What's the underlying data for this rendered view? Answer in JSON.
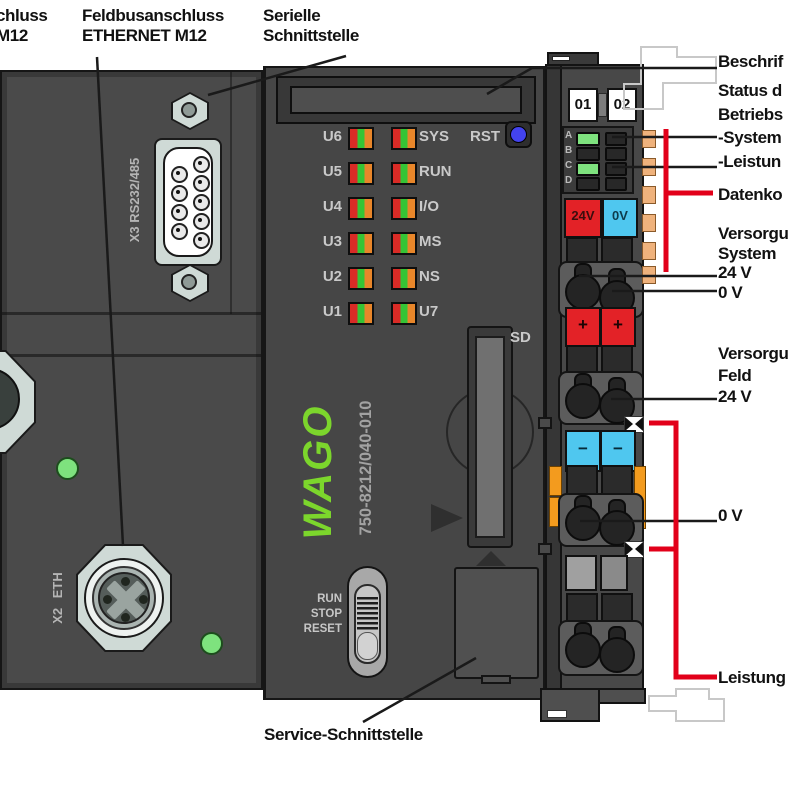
{
  "colors": {
    "body": "#4a4a4a",
    "body2": "#464646",
    "strip": "#383838",
    "wago_green": "#7cd62c",
    "led_red": "#d92b26",
    "led_green": "#35c435",
    "led_orange": "#e8862a",
    "status_green": "#7ee27e",
    "btn_red": "#e32227",
    "btn_cyan": "#4fc7ef",
    "btn_blue": "#4343ee",
    "clip_orange": "#f39b1e",
    "contact_tan": "#efb27c",
    "callout_red": "#e2001a",
    "callout_black": "#1a1a1a",
    "metal": "#cfdad6",
    "ghost": "#c8c8c8"
  },
  "labels": {
    "top_power": "chluss\nM12",
    "top_fieldbus": "Feldbusanschluss\nETHERNET M12",
    "top_serial": "Serielle\nSchnittstelle",
    "bottom_service": "Service-Schnittstelle",
    "right_marking": "Beschrif",
    "right_status": "Status d\nBetriebs\n-System\n-Leistun",
    "right_data": "Datenko",
    "right_supply_system": "Versorgu\nSystem\n24 V\n0 V",
    "right_supply_field": "Versorgu\nFeld\n24 V",
    "right_zero_v": "0 V",
    "right_power": "Leistung"
  },
  "controller": {
    "led_rows": [
      {
        "u": "U6",
        "s": "SYS"
      },
      {
        "u": "U5",
        "s": "RUN"
      },
      {
        "u": "U4",
        "s": "I/O"
      },
      {
        "u": "U3",
        "s": "MS"
      },
      {
        "u": "U2",
        "s": "NS"
      },
      {
        "u": "U1",
        "s": "U7"
      }
    ],
    "rst": "RST",
    "logo": "WAGO",
    "part_number": "750-8212/040-010",
    "sd": "SD",
    "mode_switch": "RUN\nSTOP\nRESET",
    "dsub": "X3 RS232/485",
    "eth": "X2 ETH"
  },
  "module": {
    "slot_numbers": [
      "01",
      "02"
    ],
    "led_letters": [
      "A",
      "B",
      "C",
      "D"
    ],
    "v24": "24V",
    "v0": "0V",
    "plus": "+",
    "minus": "−"
  }
}
